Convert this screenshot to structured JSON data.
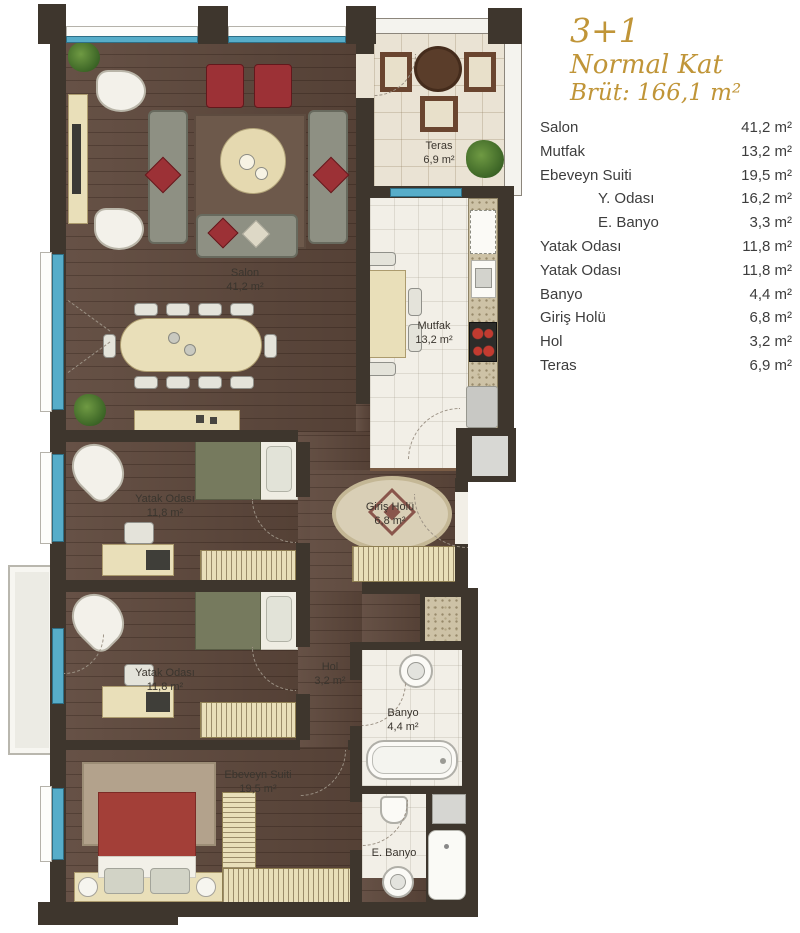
{
  "palette": {
    "accent": "#c09538",
    "wall": "#3e362d",
    "wood_floor": "#5e483c",
    "window_blue": "#57adc9",
    "text": "#3d3d3d"
  },
  "header": {
    "plan_type": "3+1",
    "floor": "Normal Kat",
    "gross_area": "Brüt: 166,1 m²"
  },
  "legend": {
    "rows": [
      {
        "label": "Salon",
        "value": "41,2 m²",
        "indent": false
      },
      {
        "label": "Mutfak",
        "value": "13,2 m²",
        "indent": false
      },
      {
        "label": "Ebeveyn Suiti",
        "value": "19,5 m²",
        "indent": false
      },
      {
        "label": "Y. Odası",
        "value": "16,2 m²",
        "indent": true
      },
      {
        "label": "E. Banyo",
        "value": "3,3 m²",
        "indent": true
      },
      {
        "label": "Yatak Odası",
        "value": "11,8 m²",
        "indent": false
      },
      {
        "label": "Yatak Odası",
        "value": "11,8 m²",
        "indent": false
      },
      {
        "label": "Banyo",
        "value": "4,4 m²",
        "indent": false
      },
      {
        "label": "Giriş Holü",
        "value": "6,8 m²",
        "indent": false
      },
      {
        "label": "Hol",
        "value": "3,2 m²",
        "indent": false
      },
      {
        "label": "Teras",
        "value": "6,9 m²",
        "indent": false
      }
    ]
  },
  "plan": {
    "rooms": [
      {
        "label": "Salon",
        "area": "41,2 m²"
      },
      {
        "label": "Mutfak",
        "area": "13,2 m²"
      },
      {
        "label": "Teras",
        "area": "6,9 m²"
      },
      {
        "label": "Yatak Odası",
        "area": "11,8 m²"
      },
      {
        "label": "Yatak Odası",
        "area": "11,8 m²"
      },
      {
        "label": "Giriş Holü",
        "area": "6,8 m²"
      },
      {
        "label": "Hol",
        "area": "3,2 m²"
      },
      {
        "label": "Banyo",
        "area": "4,4 m²"
      },
      {
        "label": "E. Banyo",
        "area": ""
      },
      {
        "label": "Ebeveyn Suiti",
        "area": "19,5 m²"
      }
    ]
  }
}
